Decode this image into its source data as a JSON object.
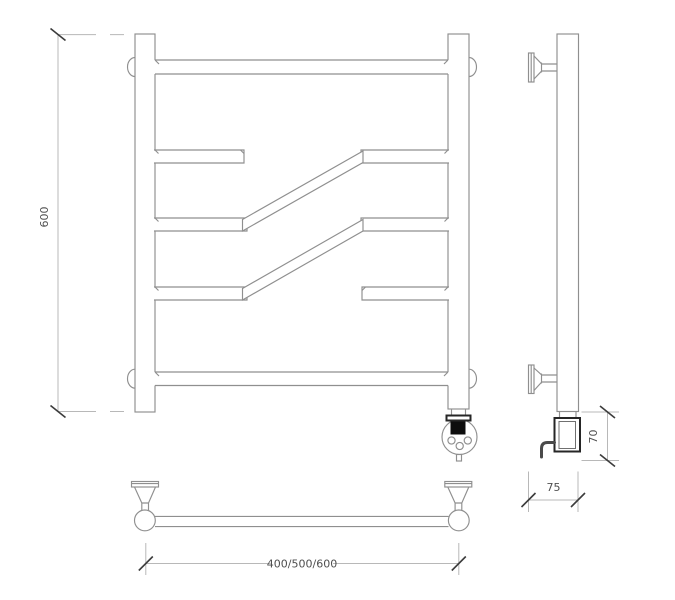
{
  "drawing": {
    "type": "heated towel rail technical drawing",
    "dimensions": {
      "height": "600",
      "element_height": "70",
      "depth": "75",
      "width_options": "400/500/600"
    },
    "colors": {
      "background": "#ffffff",
      "outline": "#8f8f8f",
      "dimension_line": "#b8b8b8",
      "tick": "#3c3c3c",
      "text": "#4f4f4f",
      "bold_outline": "#262626",
      "display_fill": "#0d0d0d"
    }
  }
}
